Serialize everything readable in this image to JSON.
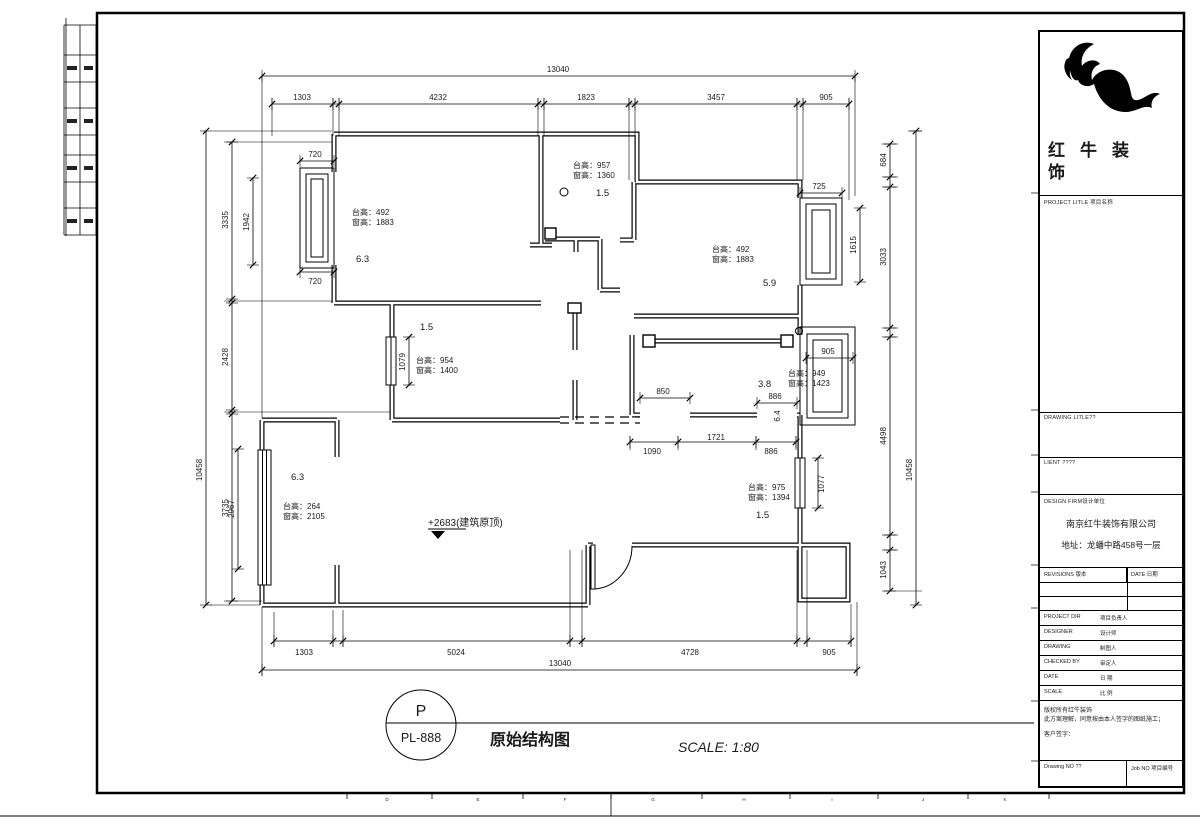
{
  "sheet": {
    "bottom_letters": [
      "D",
      "E",
      "F",
      "G",
      "H",
      "I",
      "J",
      "K"
    ]
  },
  "stamp": {
    "letter": "P",
    "code": "PL-888",
    "title": "原始结构图",
    "scale": "SCALE: 1:80"
  },
  "title_block": {
    "brand_l1": "红牛装",
    "brand_l2": "饰",
    "project_title_label": "PROJECT LITLE 项目名称",
    "drawing_title_label": "DRAWING LITLE??",
    "client_label": "LIENT ????",
    "design_firm_label": "DESIGN FIRM设计单位",
    "firm_name": "南京红牛装饰有限公司",
    "firm_address": "地址：龙蟠中路458号一层",
    "revisions_label": "REVISIONS 版本",
    "revisions_date_label": "DATE 日期",
    "project_dir_label": "PROJECT DIR",
    "project_dir_cn": "项目负责人",
    "designer_label": "DESIGNER",
    "designer_cn": "设计师",
    "drawing_label": "DRAWING",
    "drawing_cn": "制图人",
    "checked_label": "CHECKED BY",
    "checked_cn": "审定人",
    "date_label": "DATE",
    "date_cn": "日 期",
    "scale_label": "SCALE",
    "scale_cn": "比 例",
    "copyright_1": "版权所有红牛装饰",
    "copyright_2": "此方案理解，同意按由本人签字的图纸施工；",
    "copyright_3": "客户签字：",
    "drawing_no_label": "Drawing NO ??",
    "job_no_label": "Job NO 项目编号"
  },
  "dims": {
    "top": {
      "overall": "13040",
      "segs": [
        "1303",
        "4232",
        "1823",
        "3457",
        "905"
      ]
    },
    "bottom": {
      "overall": "13040",
      "segs": [
        "1303",
        "5024",
        "4728",
        "905"
      ]
    },
    "left": {
      "overall": "10458",
      "segs": [
        "3335",
        "2428",
        "3735"
      ],
      "win_top": "1942",
      "win_bottom": "2967",
      "w720a": "720",
      "w720b": "720"
    },
    "right": {
      "overall": "10458",
      "segs": [
        "684",
        "3033",
        "4498",
        "1043"
      ],
      "bay": "1615",
      "d725": "725",
      "d905": "905",
      "d1077": "1077"
    },
    "middle": {
      "d850": "850",
      "d886a": "886",
      "d886b": "886",
      "d1090": "1090",
      "d1721": "1721",
      "d1079": "1079"
    }
  },
  "rooms": {
    "tl": {
      "sill": "台高：492",
      "win": "窗高：1883",
      "no": "6.3"
    },
    "tm": {
      "sill": "台高：957",
      "win": "窗高：1360",
      "no": "1.5"
    },
    "tr": {
      "sill": "台高：492",
      "win": "窗高：1883",
      "no": "5.9"
    },
    "ml": {
      "sill": "台高：954",
      "win": "窗高：1400",
      "no": "1.5"
    },
    "mr": {
      "sill": "台高：949",
      "win": "窗高：1423",
      "no": "3.8"
    },
    "hall": {
      "no": "6.4"
    },
    "living": {
      "sill": "台高：264",
      "win": "窗高：2105",
      "no": "6.3",
      "level": "+2683(建筑原顶)"
    },
    "br": {
      "sill": "台高：975",
      "win": "窗高：1394",
      "no": "1.5"
    }
  }
}
